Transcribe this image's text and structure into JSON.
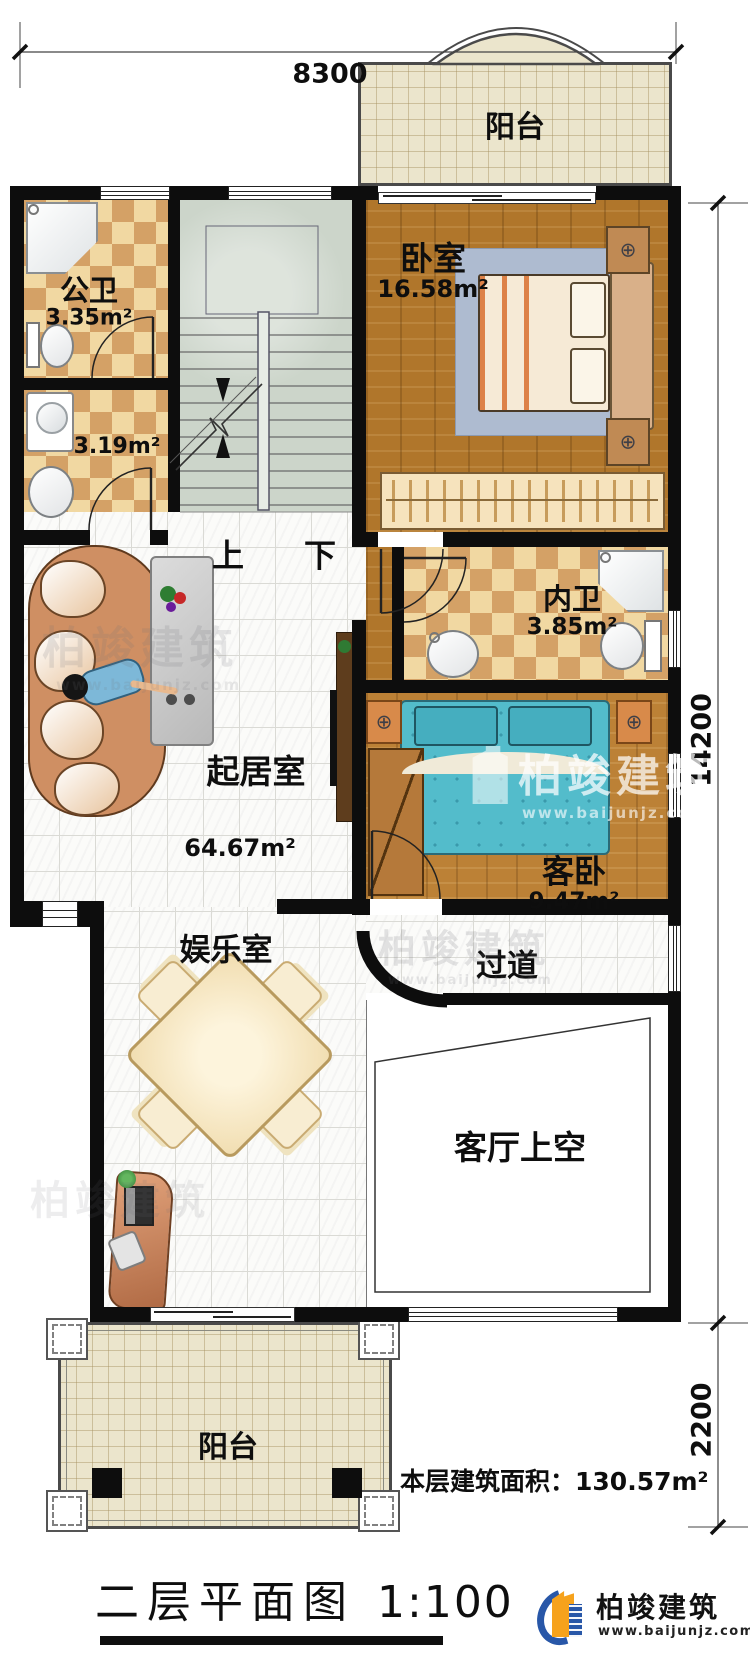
{
  "drawing": {
    "title": "二层平面图",
    "scale": "1:100",
    "floor_area_label": "本层建筑面积：",
    "floor_area_value": "130.57m²"
  },
  "dimensions": {
    "top_width": "8300",
    "right_height_main": "14200",
    "right_height_lower": "2200"
  },
  "rooms": {
    "balcony_top": {
      "label": "阳台"
    },
    "public_bath": {
      "label": "公卫",
      "area": "3.35m²"
    },
    "laundry": {
      "area": "3.19m²"
    },
    "bedroom": {
      "label": "卧室",
      "area": "16.58m²"
    },
    "inner_bath": {
      "label": "内卫",
      "area": "3.85m²"
    },
    "living": {
      "label": "起居室",
      "area": "64.67m²"
    },
    "guest_bedroom": {
      "label": "客卧",
      "area": "9.47m²"
    },
    "entertainment": {
      "label": "娱乐室"
    },
    "corridor": {
      "label": "过道"
    },
    "living_void": {
      "label": "客厅上空"
    },
    "balcony_bottom": {
      "label": "阳台"
    }
  },
  "stairs": {
    "up_label": "上",
    "down_label": "下"
  },
  "watermark": {
    "name": "柏竣建筑",
    "url": "www.baijunjz.com"
  },
  "logo": {
    "name": "柏竣建筑",
    "url": "www.baijunjz.com"
  },
  "colors": {
    "wall": "#0d0d0d",
    "wood_floor": "#b0762b",
    "checker_light": "#f1d8a2",
    "checker_dark": "#d4a166",
    "stairs": "#ccd5ca",
    "balcony_tile": "#ebe5cc",
    "logo_blue": "#2857a8",
    "logo_orange": "#f6a21c"
  }
}
